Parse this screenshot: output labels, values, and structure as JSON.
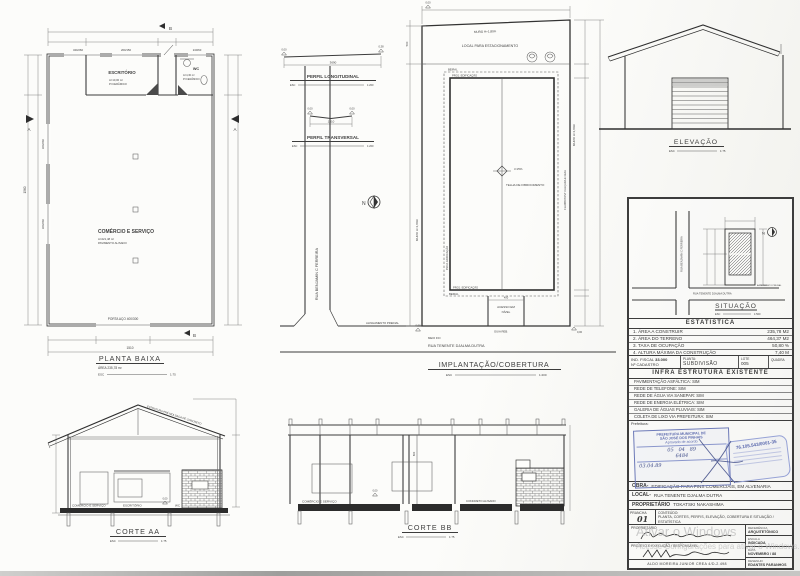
{
  "colors": {
    "ink": "#3f3f3f",
    "stamp_blue": "#5c6aae",
    "watermark": "#c1c1c1"
  },
  "planta": {
    "title": "PLANTA BAIXA",
    "area": "ÁREA 235,78 m²",
    "esc": "ESC",
    "scale": "1:75",
    "escritorio": "ESCRITÓRIO",
    "escritorio_a": "A=10,00 m²",
    "escritorio_p": "P=CERÂMICO",
    "wc": "WC",
    "wc_a": "A=4,30 m²",
    "wc_p": "P=CERÂMICO",
    "comercio": "COMÉRCIO E SERVIÇO",
    "comercio_a": "A=221,48 m²",
    "comercio_p": "PAVIMENTO ALISADO",
    "porta": "PORTA AÇO 400/300",
    "tag1": "340/260",
    "tag2": "200/150",
    "tag3": "240/60",
    "tag4": "360/260",
    "tag5": "360/260",
    "dim_w": "1510",
    "dim_h": "1560",
    "ma": "A",
    "mb": "B"
  },
  "perfil_long": {
    "title": "PERFIL LONGITUDINAL",
    "esc": "ESC",
    "scale": "1:200",
    "dim": "3690",
    "lv1": "0,00",
    "lv2": "0,38"
  },
  "perfil_trans": {
    "title": "PERFIL TRANSVERSAL",
    "esc": "ESC",
    "scale": "1:200",
    "dim": "1510",
    "lv1": "0,00",
    "lv2": "0,00"
  },
  "impl": {
    "title": "IMPLANTAÇÃO/COBERTURA",
    "esc": "ESC",
    "scale": "1:200",
    "muro": "MURO H=1,80m",
    "estac": "LOCAL PARA ESTACIONAMENTO",
    "beiral": "BEIRAL",
    "proj": "PROJ. EDIFICAÇÃO",
    "incl": "i=15%",
    "telha": "TELHA DE FIBROCIMENTO",
    "flamb": "FLAMBOYANT CALÇADA E GUIA",
    "acesso1": "ACESSO EM",
    "acesso2": "NÍVEL",
    "meiofio": "MEIO FIO",
    "guia": "GUIA REB.",
    "alinh": "ALINHAMENTO PREDIAL",
    "rua_v": "RUA BENJAMIN C FERREIRA",
    "rua_h": "RUA TENENTE DJALMA DUTRA",
    "n": "N",
    "d400": "400",
    "d500": "500",
    "zero": "0,00"
  },
  "elevacao": {
    "title": "ELEVAÇÃO",
    "esc": "ESC",
    "scale": "1:75"
  },
  "situacao": {
    "title": "SITUAÇÃO",
    "esc": "ESC",
    "scale": "1:500",
    "rua_v": "RUA BENJAMIN C FERREIRA",
    "rua_h": "RUA TENENTE DJALMA DUTRA",
    "alinh": "ALINHAMENTO PREDIAL",
    "n": "N"
  },
  "corte_aa": {
    "title": "CORTE AA",
    "esc": "ESC",
    "scale": "1:75",
    "roof": "ESTRUTURA PRÉ MOLDADA DE CONCRETO",
    "room1": "COMÉRCIO E SERVIÇO",
    "room2": "ESCRITÓRIO",
    "room3": "WC",
    "zero": "0,00"
  },
  "corte_bb": {
    "title": "CORTE BB",
    "esc": "ESC",
    "scale": "1:75",
    "room": "COMÉRCIO E SERVIÇO",
    "floor": "CONCRETO ALISADO",
    "zero": "0,00",
    "d600": "600"
  },
  "tb": {
    "estat_header": "ESTATISTICA",
    "r1l": "1. ÁREA A CONSTRUIR",
    "r1v": "235,78 M2",
    "r2l": "2. ÁREA DO TERRENO",
    "r2v": "464,37 M2",
    "r3l": "3. TAXA DE OCUPAÇÃO",
    "r3v": "50,80 %",
    "r4l": "4. ALTURA MÁXIMA DA CONSTRUÇÃO",
    "r4v": "7,40 M",
    "c1a": "IND. FISCAL",
    "c1b": "33.000",
    "c1c": "Nº CADASTRO",
    "c2a": "PLANTA:",
    "c2b": "SUBDIVISÃO",
    "c3a": "LOTE",
    "c3b": "005",
    "c4a": "QUADRA",
    "infra_header": "INFRA ESTRUTURA EXISTENTE",
    "infra1": "PAVIMENTAÇÃO ASFÁLTICA: SIM",
    "infra2": "REDE DE TELEFONE: SIM",
    "infra3": "REDE DE ÁGUA VIA SANEPAR: SIM",
    "infra4": "REDE DE ENERGIA ELÉTRICA: SIM",
    "infra5": "GALERIA DE ÁGUAS PLUVIAIS: SIM",
    "infra6": "COLETA DE LIXO VIA PREFEITURA: SIM",
    "prefeitura": "Prefeitura:",
    "s1l1": "PREFEITURA MUNICIPAL DE",
    "s1l2": "SÃO JOSÉ DOS PINHAIS",
    "s1l3": "Aprovado de acordo",
    "s1d1": "05",
    "s1d2": "04",
    "s1d3": "89",
    "s1n": "6484",
    "s1d4": "03.04.89",
    "s2n": "76.105.543/0001-35",
    "obra_l": "OBRA-",
    "obra_v": "EDIFICAÇÃO PARA FINS COMERCIAIS, EM ALVENARIA",
    "local_l": "LOCAL-",
    "local_v": "RUA TENENTE DJALMA DUTRA",
    "prop_l": "PROPRIETÁRIO",
    "prop_v": "TOKATSKI NAKASHIMA",
    "prancha_l": "PRANCHA",
    "prancha_v": "01",
    "cont_l": "CONTEÚDO:",
    "cont_v": "PLANTA, CORTES, PERFIS, ELEVAÇÃO, COBERTURA E SITUAÇÃO / ESTATÍSTICA",
    "sig1": "PROPRIETÁRIO",
    "sig2": "PROJETO E EXECUÇÃO / RESPONSÁVEL",
    "crea": "ALDO MOREIRA JUNIOR    CREA 4/D-2.498",
    "ref_l": "REFERÊNCIA",
    "ref_v": "ARQUITETÔNICO",
    "esc_l": "ESCALA",
    "esc_v": "INDICADA",
    "data_l": "DATA",
    "data_v": "NOVEMBRO / 88",
    "des_l": "DESENHO",
    "des_v": "EDANTES PARANHOS"
  },
  "watermark": {
    "l1": "Ativar o Windows",
    "l2": "Acesse Configurações para ativar o Windows."
  }
}
